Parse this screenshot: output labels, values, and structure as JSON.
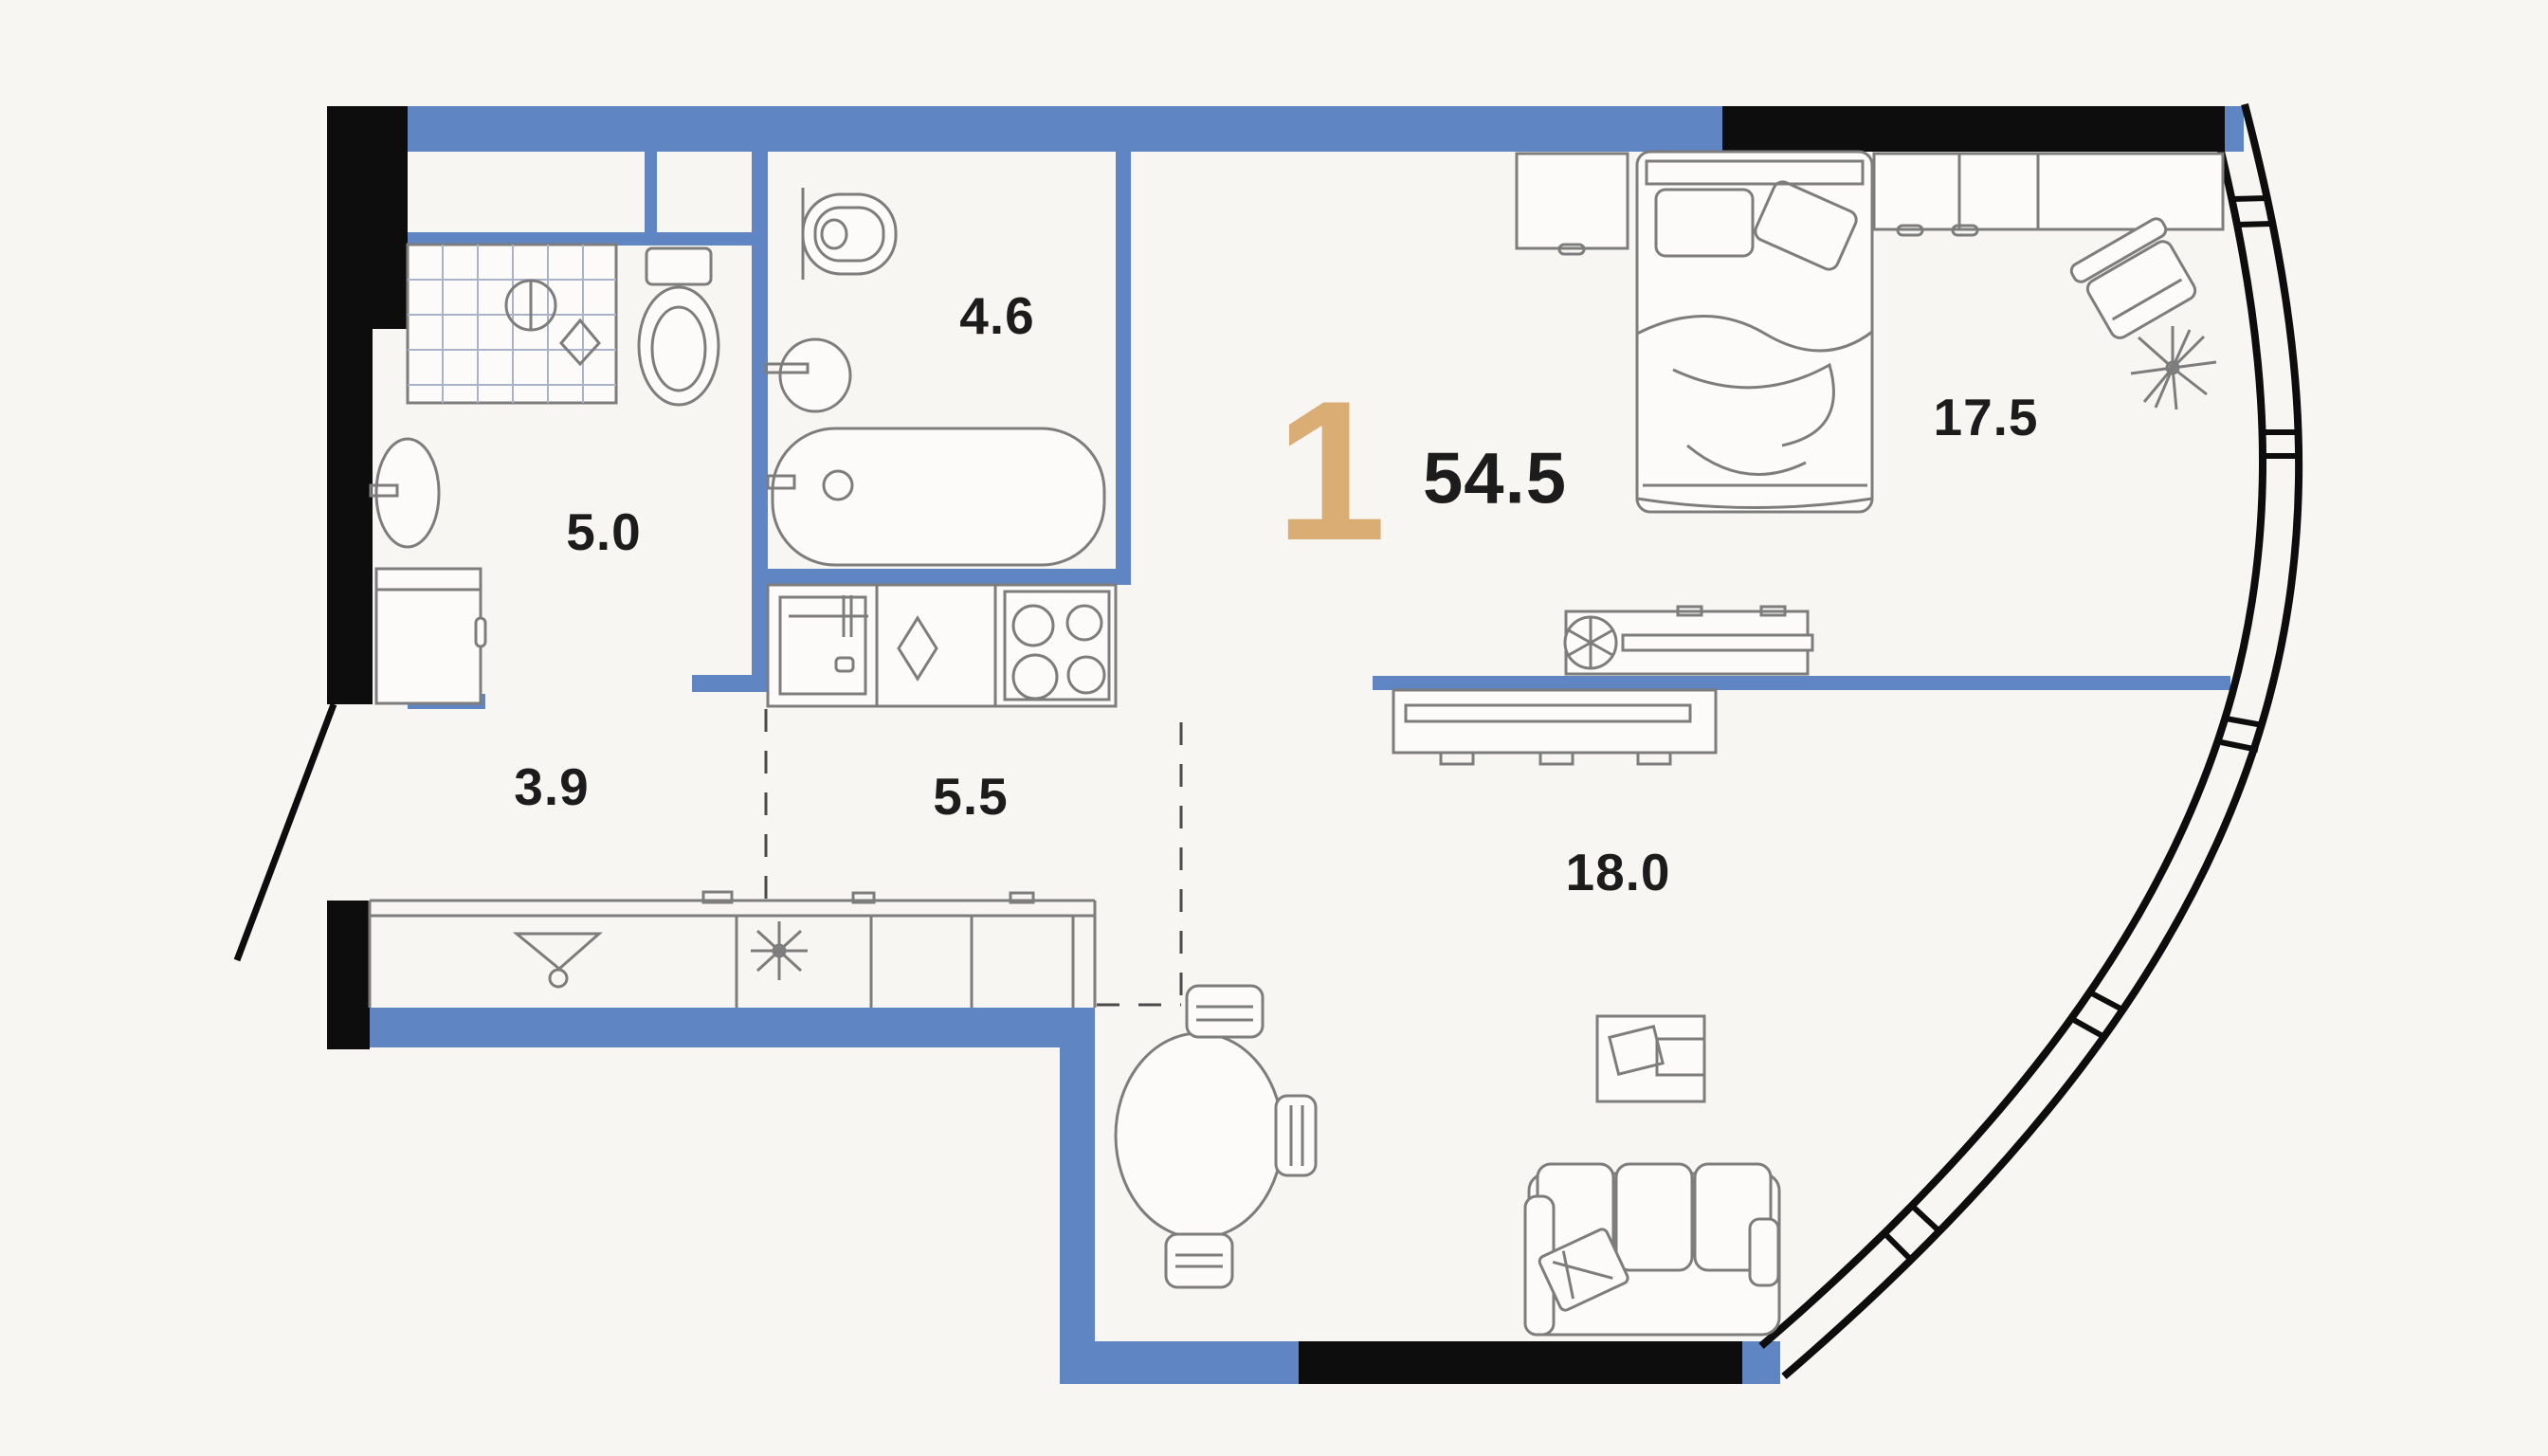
{
  "floorplan": {
    "unit_label": "1",
    "total_area": "54.5",
    "rooms": [
      {
        "name": "shower-room",
        "area": "5.0"
      },
      {
        "name": "bathroom",
        "area": "4.6"
      },
      {
        "name": "hallway",
        "area": "3.9"
      },
      {
        "name": "kitchen",
        "area": "5.5"
      },
      {
        "name": "bedroom",
        "area": "17.5"
      },
      {
        "name": "living-room",
        "area": "18.0"
      }
    ],
    "fixtures": [
      "shower",
      "toilet",
      "washbasin",
      "washing-machine",
      "bathtub",
      "kitchen-sink",
      "hob",
      "wardrobe",
      "hanger-icon",
      "fan-icon",
      "bed",
      "nightstand",
      "desk",
      "desk-chair",
      "plant-icon",
      "tv-console",
      "media-console",
      "dining-table",
      "dining-chair",
      "sofa",
      "coffee-table",
      "entrance-door",
      "panoramic-glazing"
    ],
    "colors": {
      "wall": "#5f85c2",
      "structure": "#0d0d0d",
      "accent": "#d9ad74",
      "line": "#7d7d7d",
      "grid": "#a9b2c6",
      "background": "#f7f6f2",
      "text": "#1c1c1c"
    }
  }
}
